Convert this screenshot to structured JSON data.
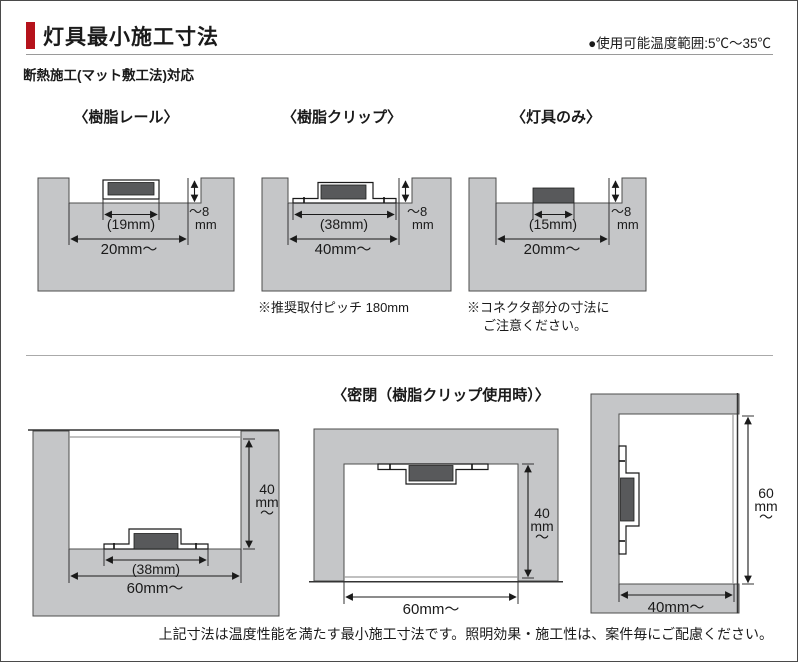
{
  "colors": {
    "accent": "#b5121b",
    "block_gray": "#c5c6c8",
    "fixture_dark": "#58595b"
  },
  "header": {
    "title": "灯具最小施工寸法",
    "temp_note": "●使用可能温度範囲:5℃～35℃"
  },
  "subtitle": "断熱施工(マット敷工法)対応",
  "top": {
    "rail": {
      "heading": "〈樹脂レール〉",
      "inner": "(19mm)",
      "opening": "20mm～",
      "depth1": "～8",
      "depth2": "mm"
    },
    "clip": {
      "heading": "〈樹脂クリップ〉",
      "inner": "(38mm)",
      "opening": "40mm～",
      "depth1": "～8",
      "depth2": "mm",
      "note": "※推奨取付ピッチ 180mm"
    },
    "lamp": {
      "heading": "〈灯具のみ〉",
      "inner": "(15mm)",
      "opening": "20mm～",
      "depth1": "～8",
      "depth2": "mm",
      "note1": "※コネクタ部分の寸法に",
      "note2": "ご注意ください。"
    }
  },
  "sealed": {
    "heading": "〈密閉（樹脂クリップ使用時）〉",
    "left": {
      "inner": "(38mm)",
      "opening": "60mm～",
      "h1": "40",
      "h2": "mm",
      "h3": "～"
    },
    "middle": {
      "opening": "60mm～",
      "h1": "40",
      "h2": "mm",
      "h3": "～"
    },
    "right": {
      "opening": "40mm～",
      "h1": "60",
      "h2": "mm",
      "h3": "～"
    }
  },
  "footer": "上記寸法は温度性能を満たす最小施工寸法です。照明効果・施工性は、案件毎にご配慮ください。"
}
